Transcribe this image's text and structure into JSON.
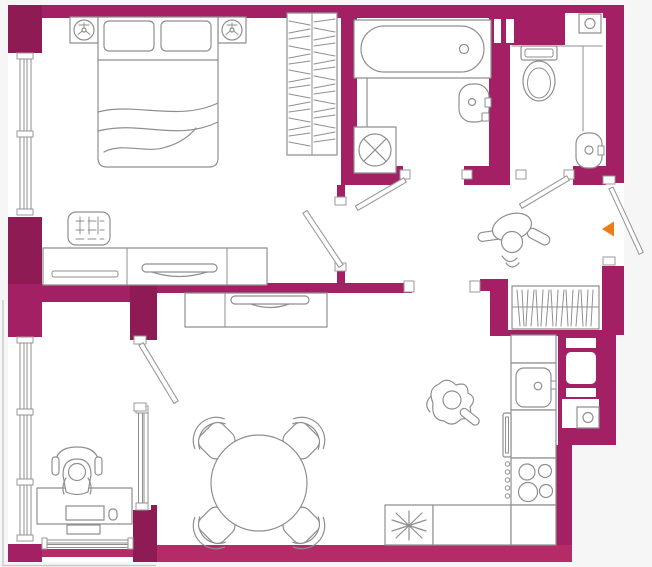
{
  "colors": {
    "wall": "#a22063",
    "wall_dark": "#8e1b53",
    "wall_light": "#b52b68",
    "line": "#8f8f8f",
    "line_light": "#c9c9c9",
    "floor": "#ffffff",
    "background": "#f7f6f6",
    "entrance_marker": "#ee7c16"
  },
  "plan": {
    "canvas": {
      "width": 652,
      "height": 567
    },
    "rooms": [
      {
        "name": "bedroom",
        "fixtures": [
          "double-bed",
          "pillows",
          "nightstand-left",
          "nightstand-right",
          "table-lamp-left",
          "table-lamp-right",
          "wardrobe-with-hangers",
          "ottoman",
          "dresser",
          "decor-bowl",
          "window"
        ]
      },
      {
        "name": "bathroom",
        "fixtures": [
          "bathtub",
          "washbasin",
          "washing-machine",
          "shower-screen",
          "door"
        ]
      },
      {
        "name": "wc",
        "fixtures": [
          "toilet",
          "corner-washbasin",
          "ventilation-unit",
          "duct-shafts",
          "door"
        ]
      },
      {
        "name": "hallway",
        "fixtures": [
          "coat-closet-hangers",
          "standing-person",
          "entrance-door",
          "entrance-marker"
        ]
      },
      {
        "name": "living-dining",
        "fixtures": [
          "tv-stand",
          "tv",
          "round-dining-table",
          "dining-chair-nw",
          "dining-chair-ne",
          "dining-chair-sw",
          "dining-chair-se",
          "sitting-person"
        ]
      },
      {
        "name": "office",
        "fixtures": [
          "desk",
          "desk-chair",
          "person-at-desk",
          "keyboard",
          "mouse",
          "printer",
          "interior-window",
          "window",
          "door"
        ]
      },
      {
        "name": "kitchen",
        "fixtures": [
          "countertop",
          "kitchen-sink",
          "dishwasher",
          "stove-4-burners",
          "corner-unit-star",
          "ventilation-box",
          "duct-shafts"
        ]
      }
    ],
    "markers": [
      {
        "name": "entrance-arrow",
        "shape": "triangle-left",
        "color": "#ee7c16"
      }
    ]
  }
}
